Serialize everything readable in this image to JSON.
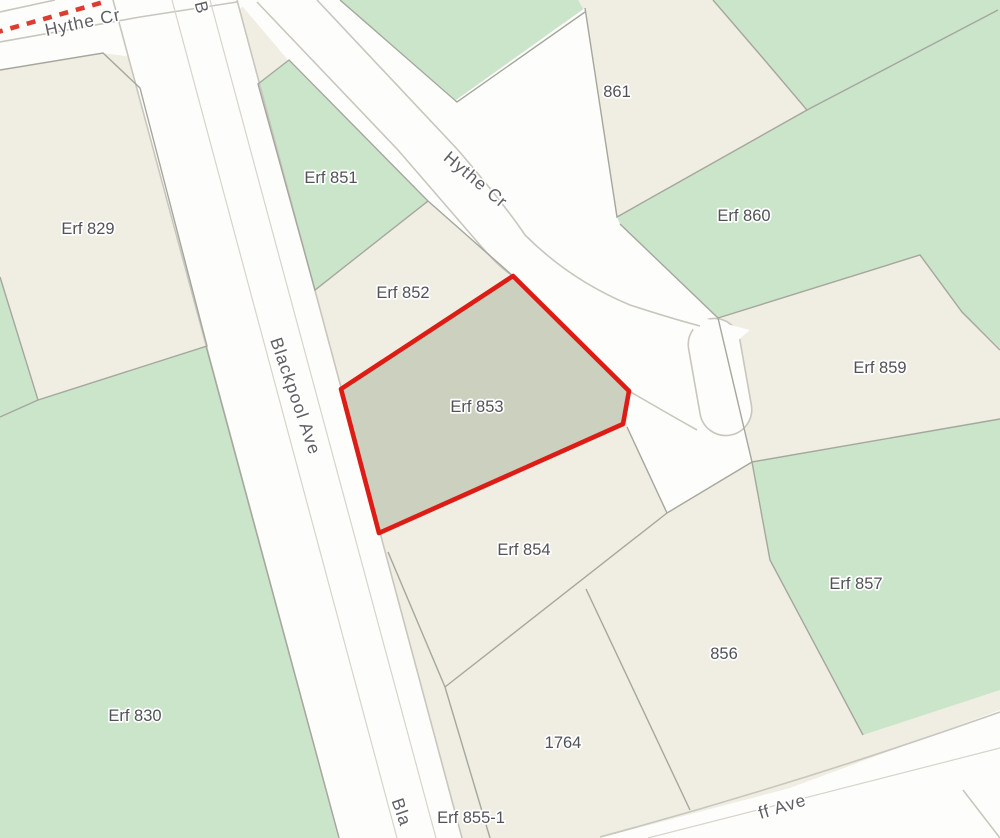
{
  "map": {
    "colors": {
      "land": "#f0ede3",
      "green_space": "#cbe5cb",
      "road_fill": "#fdfdfb",
      "road_casing": "#c8c6bd",
      "parcel_line": "#a5a79d",
      "selected_parcel_fill": "#ccd0bf",
      "selected_parcel_outline": "#dd1d15",
      "dashed_boundary": "#dd3c30",
      "parcel_label_text": "#515257",
      "street_label_text": "#5e5f64"
    },
    "selected_parcel": "Erf 853",
    "streets": {
      "hythe_top": "Hythe Cr",
      "hythe_diagonal": "Hythe Cr",
      "blackpool": "Blackpool Ave",
      "blackpool_fragment_top": "B",
      "blackpool_fragment_bottom": "Bla",
      "avenue_fragment_bottom": "ff Ave"
    },
    "parcels": [
      {
        "id": "erf-829",
        "label": "Erf 829",
        "selected": false
      },
      {
        "id": "erf-830",
        "label": "Erf 830",
        "selected": false
      },
      {
        "id": "erf-851",
        "label": "Erf 851",
        "selected": false
      },
      {
        "id": "erf-852",
        "label": "Erf 852",
        "selected": false
      },
      {
        "id": "erf-853",
        "label": "Erf 853",
        "selected": true
      },
      {
        "id": "erf-854",
        "label": "Erf 854",
        "selected": false
      },
      {
        "id": "erf-855-1",
        "label": "Erf 855-1",
        "selected": false
      },
      {
        "id": "856",
        "label": "856",
        "selected": false
      },
      {
        "id": "erf-857",
        "label": "Erf 857",
        "selected": false
      },
      {
        "id": "erf-859",
        "label": "Erf 859",
        "selected": false
      },
      {
        "id": "erf-860",
        "label": "Erf 860",
        "selected": false
      },
      {
        "id": "861",
        "label": "861",
        "selected": false
      },
      {
        "id": "1764",
        "label": "1764",
        "selected": false
      }
    ]
  }
}
